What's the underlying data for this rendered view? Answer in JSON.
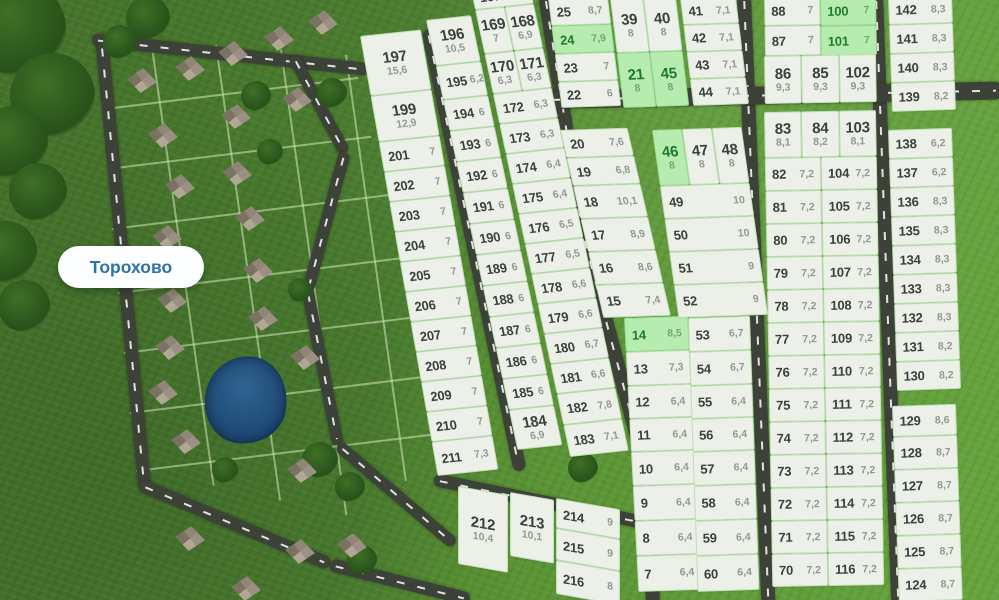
{
  "map": {
    "place_label": "Торохово",
    "colors": {
      "plot_fill": "#edf0e8",
      "plot_border": "#bfe0b6",
      "plot_number_text": "#37423a",
      "plot_area_text": "#8f9a90",
      "available_fill": "#b7ecb0",
      "available_number_text": "#1d7a2f",
      "road": "#3d4238",
      "grass": "#4b7d2f",
      "pond": "#1b4470",
      "place_label_text": "#2d73a6"
    }
  },
  "plots": {
    "groups": {
      "A1": {
        "rows": [
          [
            {
              "n": "197",
              "a": "15,6"
            }
          ],
          [
            {
              "n": "199",
              "a": "12,9"
            }
          ],
          [
            {
              "n": "201",
              "a": "7"
            }
          ],
          [
            {
              "n": "202",
              "a": "7"
            }
          ],
          [
            {
              "n": "203",
              "a": "7"
            }
          ],
          [
            {
              "n": "204",
              "a": "7"
            }
          ],
          [
            {
              "n": "205",
              "a": "7"
            }
          ],
          [
            {
              "n": "206",
              "a": "7"
            }
          ],
          [
            {
              "n": "207",
              "a": "7"
            }
          ],
          [
            {
              "n": "208",
              "a": "7"
            }
          ],
          [
            {
              "n": "209",
              "a": "7"
            }
          ],
          [
            {
              "n": "210",
              "a": "7"
            }
          ],
          [
            {
              "n": "211",
              "a": "7,3"
            }
          ]
        ]
      },
      "A2": {
        "rows": [
          [
            {
              "n": "196",
              "a": "10,5"
            }
          ],
          [
            {
              "n": "195",
              "a": "6,2"
            }
          ],
          [
            {
              "n": "194",
              "a": "6"
            }
          ],
          [
            {
              "n": "193",
              "a": "6"
            }
          ],
          [
            {
              "n": "192",
              "a": "6"
            }
          ],
          [
            {
              "n": "191",
              "a": "6"
            }
          ],
          [
            {
              "n": "190",
              "a": "6"
            }
          ],
          [
            {
              "n": "189",
              "a": "6"
            }
          ],
          [
            {
              "n": "188",
              "a": "6"
            }
          ],
          [
            {
              "n": "187",
              "a": "6"
            }
          ],
          [
            {
              "n": "186",
              "a": "6"
            }
          ],
          [
            {
              "n": "185",
              "a": "6"
            }
          ],
          [
            {
              "n": "184",
              "a": "6,9"
            }
          ]
        ]
      },
      "A3": {
        "rows": [
          [
            {
              "n": "167",
              "a": "7"
            }
          ],
          [
            {
              "n": "169",
              "a": "7"
            },
            {
              "n": "168",
              "a": "6,9"
            }
          ],
          [
            {
              "n": "170",
              "a": "6,3"
            },
            {
              "n": "171",
              "a": "6,3"
            }
          ],
          [
            {
              "n": "172",
              "a": "6,3"
            }
          ],
          [
            {
              "n": "173",
              "a": "6,3"
            }
          ],
          [
            {
              "n": "174",
              "a": "6,4"
            }
          ],
          [
            {
              "n": "175",
              "a": "6,4"
            }
          ],
          [
            {
              "n": "176",
              "a": "6,5"
            }
          ],
          [
            {
              "n": "177",
              "a": "6,5"
            }
          ],
          [
            {
              "n": "178",
              "a": "6,6"
            }
          ],
          [
            {
              "n": "179",
              "a": "6,6"
            }
          ],
          [
            {
              "n": "180",
              "a": "6,7"
            }
          ],
          [
            {
              "n": "181",
              "a": "6,6"
            }
          ],
          [
            {
              "n": "182",
              "a": "7,8"
            }
          ],
          [
            {
              "n": "183",
              "a": "7,1"
            }
          ]
        ]
      },
      "M1t": {
        "rows": [
          [
            {
              "n": "25",
              "a": "8,7"
            }
          ],
          [
            {
              "n": "24",
              "a": "7,9",
              "f": "g"
            }
          ],
          [
            {
              "n": "23",
              "a": "7"
            }
          ],
          [
            {
              "n": "22",
              "a": "6"
            }
          ]
        ]
      },
      "M2t": {
        "rows": [
          [
            {
              "n": "39",
              "a": "8"
            },
            {
              "n": "40",
              "a": "8"
            }
          ],
          [
            {
              "n": "21",
              "a": "8",
              "f": "g"
            },
            {
              "n": "45",
              "a": "8",
              "f": "g"
            }
          ]
        ]
      },
      "M3t": {
        "rows": [
          [
            {
              "n": "41",
              "a": "7,1"
            }
          ],
          [
            {
              "n": "42",
              "a": "7,1"
            }
          ],
          [
            {
              "n": "43",
              "a": "7,1"
            }
          ],
          [
            {
              "n": "44",
              "a": "7,1"
            }
          ]
        ]
      },
      "M1b1": {
        "rows": [
          [
            {
              "n": "20",
              "a": "7,6"
            }
          ],
          [
            {
              "n": "19",
              "a": "6,8"
            }
          ],
          [
            {
              "n": "18",
              "a": "10,1"
            }
          ],
          [
            {
              "n": "17",
              "a": "8,9"
            }
          ],
          [
            {
              "n": "16",
              "a": "8,6"
            }
          ],
          [
            {
              "n": "15",
              "a": "7,4"
            }
          ]
        ]
      },
      "M1b2": {
        "rows": [
          [
            {
              "n": "14",
              "a": "8,5",
              "f": "g"
            }
          ],
          [
            {
              "n": "13",
              "a": "7,3"
            }
          ],
          [
            {
              "n": "12",
              "a": "6,4"
            }
          ],
          [
            {
              "n": "11",
              "a": "6,4"
            }
          ],
          [
            {
              "n": "10",
              "a": "6,4"
            }
          ],
          [
            {
              "n": "9",
              "a": "6,4"
            }
          ],
          [
            {
              "n": "8",
              "a": "6,4"
            }
          ],
          [
            {
              "n": "7",
              "a": "6,4"
            }
          ]
        ]
      },
      "M2b1": {
        "rows": [
          [
            {
              "n": "46",
              "a": "8",
              "f": "g"
            },
            {
              "n": "47",
              "a": "8"
            },
            {
              "n": "48",
              "a": "8"
            }
          ],
          [
            {
              "n": "49",
              "a": "10"
            }
          ],
          [
            {
              "n": "50",
              "a": "10"
            }
          ],
          [
            {
              "n": "51",
              "a": "9"
            }
          ],
          [
            {
              "n": "52",
              "a": "9"
            }
          ]
        ]
      },
      "M2b2": {
        "rows": [
          [
            {
              "n": "53",
              "a": "6,7"
            }
          ],
          [
            {
              "n": "54",
              "a": "6,7"
            }
          ],
          [
            {
              "n": "55",
              "a": "6,4"
            }
          ],
          [
            {
              "n": "56",
              "a": "6,4"
            }
          ],
          [
            {
              "n": "57",
              "a": "6,4"
            }
          ],
          [
            {
              "n": "58",
              "a": "6,4"
            }
          ],
          [
            {
              "n": "59",
              "a": "6,4"
            }
          ],
          [
            {
              "n": "60",
              "a": "6,4"
            }
          ]
        ]
      },
      "R1tA": {
        "rows": [
          [
            {
              "n": "88",
              "a": "7"
            }
          ],
          [
            {
              "n": "87",
              "a": "7"
            }
          ]
        ]
      },
      "R1tB": {
        "rows": [
          [
            {
              "n": "100",
              "a": "7",
              "f": "g"
            }
          ],
          [
            {
              "n": "101",
              "a": "7",
              "f": "g"
            }
          ]
        ]
      },
      "R1tC": {
        "rows": [
          [
            {
              "n": "86",
              "a": "9,3"
            },
            {
              "n": "85",
              "a": "9,3"
            },
            {
              "n": "102",
              "a": "9,3"
            }
          ]
        ]
      },
      "R1b": {
        "rows": [
          [
            {
              "n": "83",
              "a": "8,1"
            },
            {
              "n": "84",
              "a": "8,2"
            },
            {
              "n": "103",
              "a": "8,1"
            }
          ],
          [
            {
              "n": "82",
              "a": "7,2"
            },
            {
              "n": "104",
              "a": "7,2"
            }
          ],
          [
            {
              "n": "81",
              "a": "7,2"
            },
            {
              "n": "105",
              "a": "7,2"
            }
          ],
          [
            {
              "n": "80",
              "a": "7,2"
            },
            {
              "n": "106",
              "a": "7,2"
            }
          ],
          [
            {
              "n": "79",
              "a": "7,2"
            },
            {
              "n": "107",
              "a": "7,2"
            }
          ],
          [
            {
              "n": "78",
              "a": "7,2"
            },
            {
              "n": "108",
              "a": "7,2"
            }
          ],
          [
            {
              "n": "77",
              "a": "7,2"
            },
            {
              "n": "109",
              "a": "7,2"
            }
          ],
          [
            {
              "n": "76",
              "a": "7,2"
            },
            {
              "n": "110",
              "a": "7,2"
            }
          ],
          [
            {
              "n": "75",
              "a": "7,2"
            },
            {
              "n": "111",
              "a": "7,2"
            }
          ],
          [
            {
              "n": "74",
              "a": "7,2"
            },
            {
              "n": "112",
              "a": "7,2"
            }
          ],
          [
            {
              "n": "73",
              "a": "7,2"
            },
            {
              "n": "113",
              "a": "7,2"
            }
          ],
          [
            {
              "n": "72",
              "a": "7,2"
            },
            {
              "n": "114",
              "a": "7,2"
            }
          ],
          [
            {
              "n": "71",
              "a": "7,2"
            },
            {
              "n": "115",
              "a": "7,2"
            }
          ],
          [
            {
              "n": "70",
              "a": "7,2"
            },
            {
              "n": "116",
              "a": "7,2"
            }
          ]
        ]
      },
      "R2a": {
        "rows": [
          [
            {
              "n": "142",
              "a": "8,3"
            }
          ],
          [
            {
              "n": "141",
              "a": "8,3"
            }
          ],
          [
            {
              "n": "140",
              "a": "8,3"
            }
          ],
          [
            {
              "n": "139",
              "a": "8,2"
            }
          ]
        ]
      },
      "R2b": {
        "rows": [
          [
            {
              "n": "138",
              "a": "6,2"
            }
          ],
          [
            {
              "n": "137",
              "a": "6,2"
            }
          ],
          [
            {
              "n": "136",
              "a": "8,3"
            }
          ],
          [
            {
              "n": "135",
              "a": "8,3"
            }
          ],
          [
            {
              "n": "134",
              "a": "8,3"
            }
          ],
          [
            {
              "n": "133",
              "a": "8,3"
            }
          ],
          [
            {
              "n": "132",
              "a": "8,3"
            }
          ],
          [
            {
              "n": "131",
              "a": "8,2"
            }
          ],
          [
            {
              "n": "130",
              "a": "8,2"
            }
          ]
        ]
      },
      "R2c": {
        "rows": [
          [
            {
              "n": "129",
              "a": "8,6"
            }
          ],
          [
            {
              "n": "128",
              "a": "8,7"
            }
          ],
          [
            {
              "n": "127",
              "a": "8,7"
            }
          ],
          [
            {
              "n": "126",
              "a": "8,7"
            }
          ],
          [
            {
              "n": "125",
              "a": "8,7"
            }
          ],
          [
            {
              "n": "124",
              "a": "8,7"
            }
          ]
        ]
      },
      "Bt1": {
        "rows": [
          [
            {
              "n": "212",
              "a": "10,4"
            }
          ]
        ]
      },
      "Bt2": {
        "rows": [
          [
            {
              "n": "213",
              "a": "10,1"
            }
          ]
        ]
      },
      "Bt3": {
        "rows": [
          [
            {
              "n": "214",
              "a": "9"
            }
          ],
          [
            {
              "n": "215",
              "a": "9"
            }
          ],
          [
            {
              "n": "216",
              "a": "8"
            }
          ]
        ]
      }
    }
  }
}
